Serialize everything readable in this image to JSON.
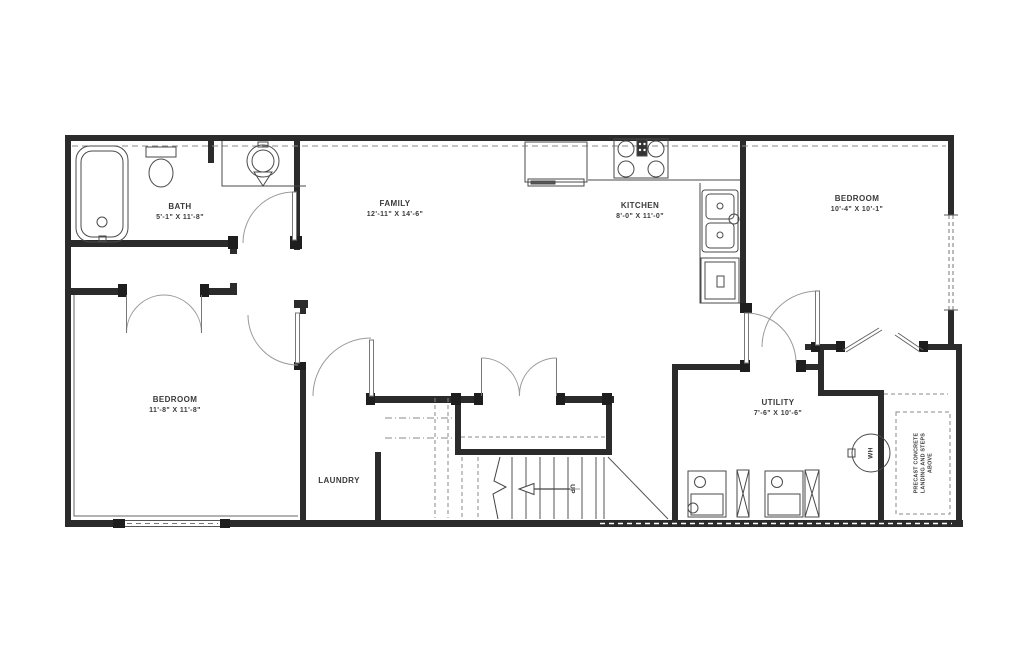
{
  "plan": {
    "title": "Basement floor plan",
    "rooms": [
      {
        "name": "BATH",
        "dims": "5'-1\" X 11'-8\""
      },
      {
        "name": "FAMILY",
        "dims": "12'-11\" X 14'-6\""
      },
      {
        "name": "KITCHEN",
        "dims": "8'-0\" X 11'-0\""
      },
      {
        "name": "BEDROOM",
        "dims": "10'-4\" X 10'-1\""
      },
      {
        "name": "BEDROOM",
        "dims": "11'-8\" X 11'-8\""
      },
      {
        "name": "LAUNDRY",
        "dims": ""
      },
      {
        "name": "UTILITY",
        "dims": "7'-6\" X 10'-6\""
      }
    ],
    "annotations": {
      "stairs_direction": "UP",
      "water_heater": "WH",
      "landing_note": [
        "PRECAST CONCRETE",
        "LANDING AND STEPS",
        "ABOVE"
      ]
    },
    "fixtures": [
      "bathtub",
      "toilet",
      "vanity-sink",
      "refrigerator",
      "stove",
      "kitchen-sink",
      "dishwasher",
      "washer",
      "dryer",
      "water-heater-tank",
      "stairs"
    ],
    "colors": {
      "walls": "#2b2b2b",
      "thin_lines": "#555555",
      "door_arcs": "#9a9a9a",
      "dashed": "#8a8a8a",
      "label_text": "#3a3a3a",
      "background": "#ffffff"
    }
  }
}
